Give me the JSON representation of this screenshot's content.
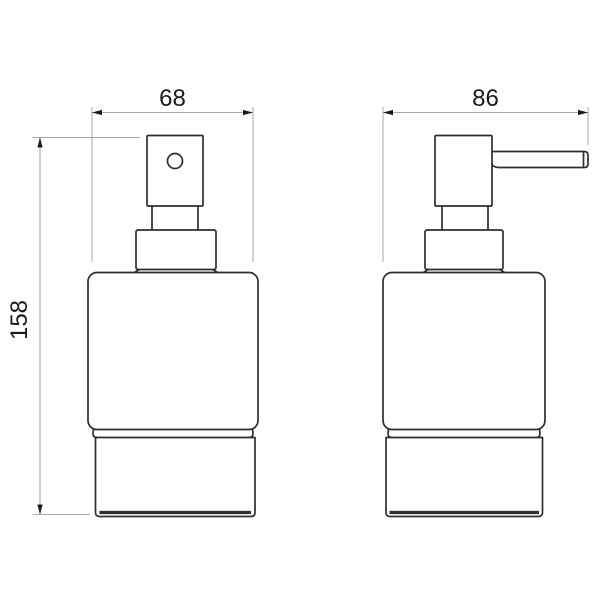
{
  "drawing": {
    "background": "#ffffff",
    "colors": {
      "outline": "#2e2e2e",
      "dimension_line": "#a9a9a9",
      "dimension_text": "#1a1a1a"
    },
    "dimensions": {
      "front_width": "68",
      "side_width": "86",
      "height": "158"
    }
  }
}
